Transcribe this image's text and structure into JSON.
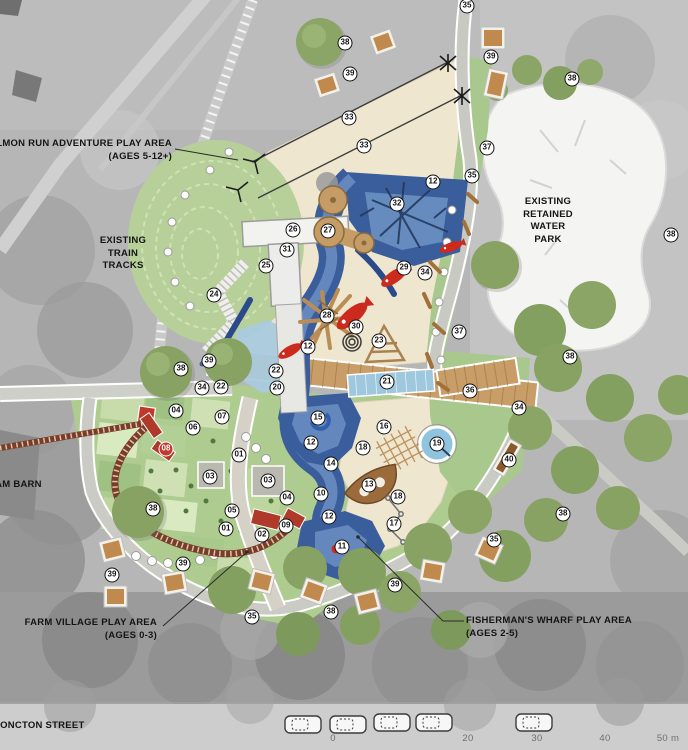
{
  "plan": {
    "labels": {
      "salmon_run": {
        "line1": "SALMON RUN ADVENTURE PLAY AREA",
        "line2": "(AGES 5-12+)"
      },
      "train_tracks": {
        "line1": "EXISTING",
        "line2": "TRAIN",
        "line3": "TRACKS"
      },
      "water_park": {
        "line1": "EXISTING",
        "line2": "RETAINED",
        "line3": "WATER",
        "line4": "PARK"
      },
      "tram_barn": {
        "line1": "TRAM BARN"
      },
      "farm_village": {
        "line1": "FARM VILLAGE PLAY AREA",
        "line2": "(AGES 0-3)"
      },
      "fishermans_wharf": {
        "line1": "FISHERMAN'S WHARF PLAY AREA",
        "line2": "(AGES 2-5)"
      },
      "street": {
        "line1": "MONCTON STREET"
      }
    },
    "scale_bar": {
      "ticks": [
        "0",
        "20",
        "30",
        "40",
        "50 m"
      ]
    },
    "markers": [
      {
        "n": "35",
        "x": 467,
        "y": 6
      },
      {
        "n": "38",
        "x": 345,
        "y": 43
      },
      {
        "n": "39",
        "x": 350,
        "y": 74
      },
      {
        "n": "39",
        "x": 491,
        "y": 57
      },
      {
        "n": "38",
        "x": 572,
        "y": 79
      },
      {
        "n": "33",
        "x": 349,
        "y": 118
      },
      {
        "n": "33",
        "x": 364,
        "y": 146
      },
      {
        "n": "37",
        "x": 487,
        "y": 148
      },
      {
        "n": "35",
        "x": 472,
        "y": 176
      },
      {
        "n": "12",
        "x": 433,
        "y": 182
      },
      {
        "n": "32",
        "x": 397,
        "y": 204
      },
      {
        "n": "26",
        "x": 293,
        "y": 230
      },
      {
        "n": "27",
        "x": 328,
        "y": 231
      },
      {
        "n": "31",
        "x": 287,
        "y": 250
      },
      {
        "n": "25",
        "x": 266,
        "y": 266
      },
      {
        "n": "24",
        "x": 214,
        "y": 295
      },
      {
        "n": "29",
        "x": 404,
        "y": 268
      },
      {
        "n": "34",
        "x": 425,
        "y": 273
      },
      {
        "n": "28",
        "x": 327,
        "y": 316
      },
      {
        "n": "30",
        "x": 356,
        "y": 327
      },
      {
        "n": "23",
        "x": 379,
        "y": 341
      },
      {
        "n": "12",
        "x": 308,
        "y": 347
      },
      {
        "n": "37",
        "x": 459,
        "y": 332
      },
      {
        "n": "38",
        "x": 671,
        "y": 235
      },
      {
        "n": "38",
        "x": 181,
        "y": 369
      },
      {
        "n": "39",
        "x": 209,
        "y": 361
      },
      {
        "n": "34",
        "x": 202,
        "y": 388
      },
      {
        "n": "22",
        "x": 221,
        "y": 387
      },
      {
        "n": "22",
        "x": 276,
        "y": 371
      },
      {
        "n": "20",
        "x": 277,
        "y": 388
      },
      {
        "n": "21",
        "x": 387,
        "y": 382
      },
      {
        "n": "04",
        "x": 176,
        "y": 411
      },
      {
        "n": "07",
        "x": 222,
        "y": 417
      },
      {
        "n": "06",
        "x": 193,
        "y": 428
      },
      {
        "n": "15",
        "x": 318,
        "y": 418
      },
      {
        "n": "16",
        "x": 384,
        "y": 427
      },
      {
        "n": "12",
        "x": 311,
        "y": 443
      },
      {
        "n": "18",
        "x": 363,
        "y": 448
      },
      {
        "n": "19",
        "x": 437,
        "y": 444
      },
      {
        "n": "14",
        "x": 331,
        "y": 464
      },
      {
        "n": "01",
        "x": 239,
        "y": 455
      },
      {
        "n": "03",
        "x": 210,
        "y": 477
      },
      {
        "n": "03",
        "x": 268,
        "y": 481
      },
      {
        "n": "13",
        "x": 369,
        "y": 485
      },
      {
        "n": "18",
        "x": 398,
        "y": 497
      },
      {
        "n": "10",
        "x": 321,
        "y": 494
      },
      {
        "n": "04",
        "x": 287,
        "y": 498
      },
      {
        "n": "05",
        "x": 232,
        "y": 511
      },
      {
        "n": "17",
        "x": 394,
        "y": 524
      },
      {
        "n": "12",
        "x": 329,
        "y": 517
      },
      {
        "n": "09",
        "x": 286,
        "y": 526
      },
      {
        "n": "01",
        "x": 226,
        "y": 529
      },
      {
        "n": "02",
        "x": 262,
        "y": 535
      },
      {
        "n": "11",
        "x": 342,
        "y": 547
      },
      {
        "n": "08",
        "x": 166,
        "y": 449,
        "red": true
      },
      {
        "n": "38",
        "x": 153,
        "y": 509
      },
      {
        "n": "39",
        "x": 112,
        "y": 575
      },
      {
        "n": "39",
        "x": 183,
        "y": 564
      },
      {
        "n": "39",
        "x": 395,
        "y": 585
      },
      {
        "n": "38",
        "x": 331,
        "y": 612
      },
      {
        "n": "35",
        "x": 252,
        "y": 617
      },
      {
        "n": "35",
        "x": 494,
        "y": 540
      },
      {
        "n": "38",
        "x": 563,
        "y": 514
      },
      {
        "n": "36",
        "x": 470,
        "y": 391
      },
      {
        "n": "34",
        "x": 519,
        "y": 408
      },
      {
        "n": "40",
        "x": 509,
        "y": 460
      },
      {
        "n": "38",
        "x": 570,
        "y": 357
      }
    ],
    "colors": {
      "water_dark": "#3a5d9c",
      "water_mid": "#6f94c6",
      "water_light": "#a9cade",
      "sand": "#efe6cf",
      "grass": "#aec98f",
      "tree": "#87a263",
      "boardwalk": "#c89d67",
      "marker_red": "#c0392b",
      "salmon_red": "#cd2a1e"
    }
  }
}
